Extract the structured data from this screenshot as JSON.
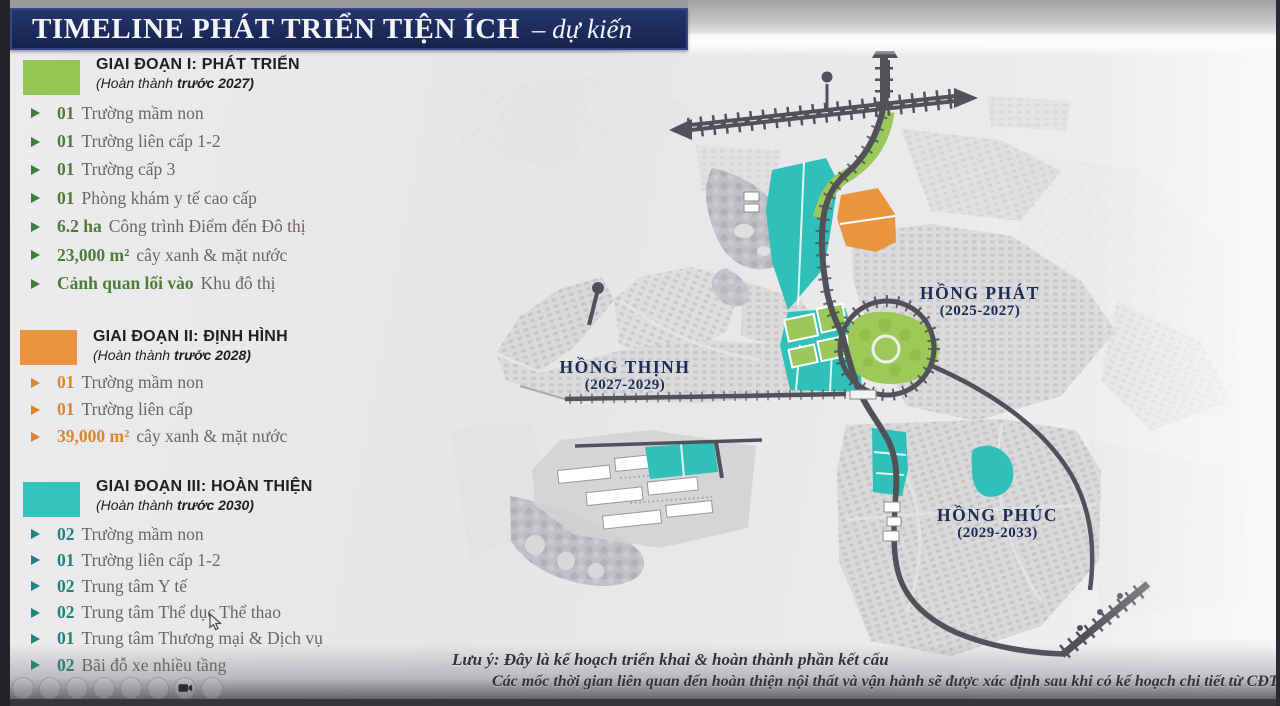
{
  "title": {
    "main": "TIMELINE PHÁT TRIỂN TIỆN ÍCH",
    "suffix": "– dự kiến"
  },
  "legend": {
    "phases": [
      {
        "id": "I",
        "header": "GIAI ĐOẠN I: PHÁT TRIỂN",
        "completion_pre": "(Hoàn thành ",
        "completion_bold": "trước 2027)",
        "swatch_color": "#95c653",
        "items": [
          {
            "value": "01",
            "text": "Trường mầm non"
          },
          {
            "value": "01",
            "text": "Trường liên cấp 1-2"
          },
          {
            "value": "01",
            "text": "Trường cấp 3"
          },
          {
            "value": "01",
            "text": "Phòng khám y tế cao cấp"
          },
          {
            "value": "6.2 ha",
            "text": "Công trình Điểm đến Đô thị"
          },
          {
            "value": "23,000 m²",
            "text": "cây xanh & mặt nước"
          },
          {
            "value": "Cảnh quan lối vào",
            "text": "Khu đô thị"
          }
        ]
      },
      {
        "id": "II",
        "header": "GIAI ĐOẠN II: ĐỊNH HÌNH",
        "completion_pre": "(Hoàn thành ",
        "completion_bold": "trước 2028)",
        "swatch_color": "#ea9440",
        "items": [
          {
            "value": "01",
            "text": "Trường mầm non"
          },
          {
            "value": "01",
            "text": "Trường liên cấp"
          },
          {
            "value": "39,000 m²",
            "text": "cây xanh & mặt nước"
          }
        ]
      },
      {
        "id": "III",
        "header": "GIAI ĐOẠN III: HOÀN THIỆN",
        "completion_pre": "(Hoàn thành ",
        "completion_bold": "trước 2030)",
        "swatch_color": "#35c2bc",
        "items": [
          {
            "value": "02",
            "text": "Trường mầm non"
          },
          {
            "value": "01",
            "text": "Trường liên cấp 1-2"
          },
          {
            "value": "02",
            "text": "Trung tâm Y tế"
          },
          {
            "value": "02",
            "text": "Trung tâm Thể dục Thể thao"
          },
          {
            "value": "01",
            "text": "Trung tâm Thương mại & Dịch vụ"
          },
          {
            "value": "02",
            "text": "Bãi đỗ xe nhiều tầng"
          }
        ]
      }
    ]
  },
  "map": {
    "areas": [
      {
        "name": "HỒNG PHÁT",
        "years": "(2025-2027)"
      },
      {
        "name": "HỒNG THỊNH",
        "years": "(2027-2029)"
      },
      {
        "name": "HỒNG PHÚC",
        "years": "(2029-2033)"
      }
    ]
  },
  "notes": {
    "line1": "Lưu ý: Đây là kế hoạch triển khai & hoàn thành phần kết cấu",
    "line2": "Các mốc thời gian liên quan đến hoàn thiện nội thất và vận hành sẽ được xác định sau khi có kế hoạch chi tiết từ CĐT"
  },
  "colors": {
    "title_navy": "#1b2a5e",
    "phase1_green": "#95c653",
    "phase2_orange": "#ea9440",
    "phase3_teal": "#35c2bc",
    "value_green": "#4e7b38",
    "value_orange": "#d8862f",
    "value_teal": "#1f837d",
    "map_label_navy": "#1d2b54",
    "road_gray": "#515257"
  },
  "toolbar": {
    "icons": [
      "circle",
      "circle",
      "circle",
      "circle",
      "circle",
      "circle",
      "camera",
      "circle"
    ]
  }
}
